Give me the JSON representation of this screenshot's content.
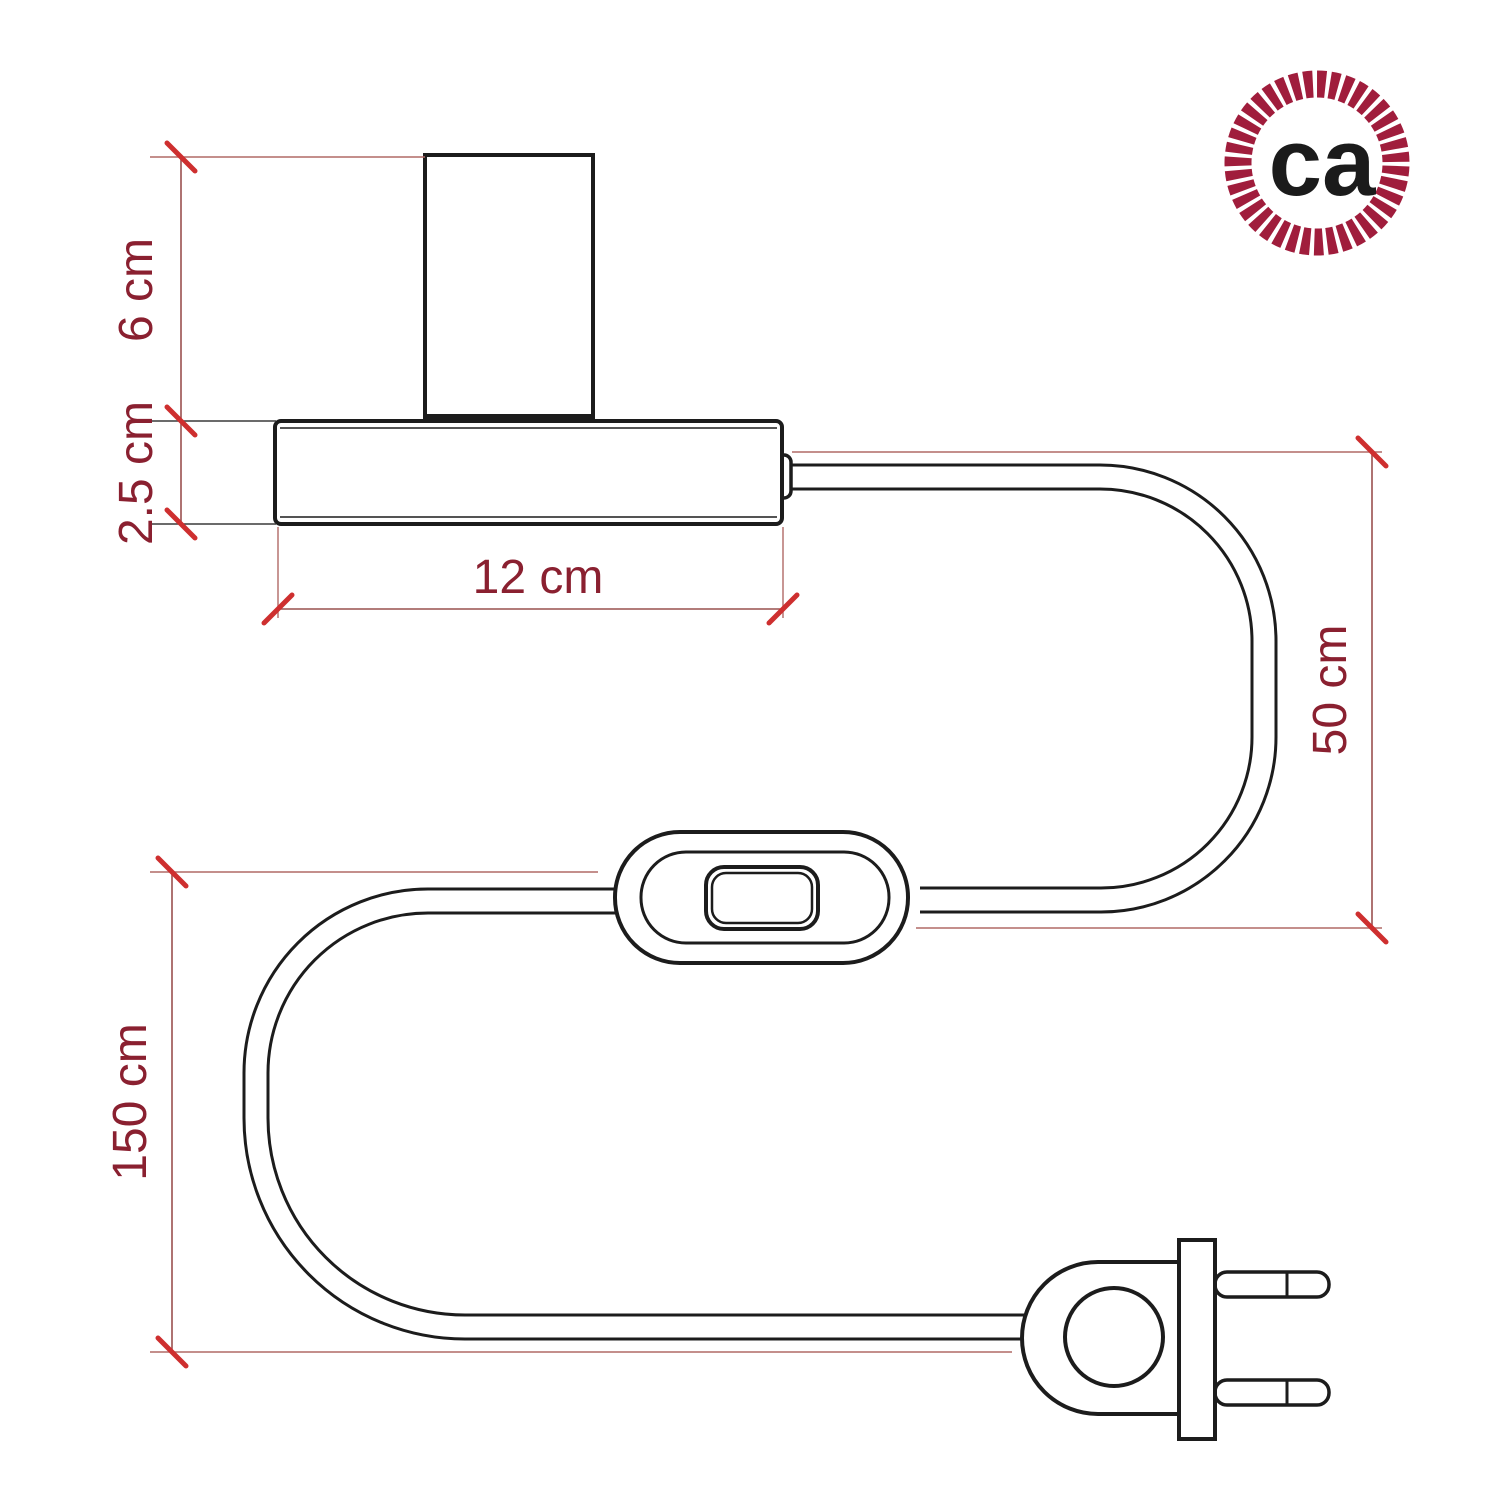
{
  "logo": {
    "monogram": "ca",
    "rope_color": "#a01d3c",
    "monogram_color": "#1b1b1b"
  },
  "dimensions": {
    "socket_height": "6 cm",
    "base_height": "2.5 cm",
    "base_width": "12 cm",
    "cable_base_to_switch": "50 cm",
    "cable_switch_to_plug": "150 cm"
  },
  "colors": {
    "background": "#ffffff",
    "outline": "#1c1c1c",
    "dimension_line": "#99504f",
    "extension_line": "#b06a66",
    "tick": "#ce2f2f",
    "label_text": "#8a2030"
  }
}
